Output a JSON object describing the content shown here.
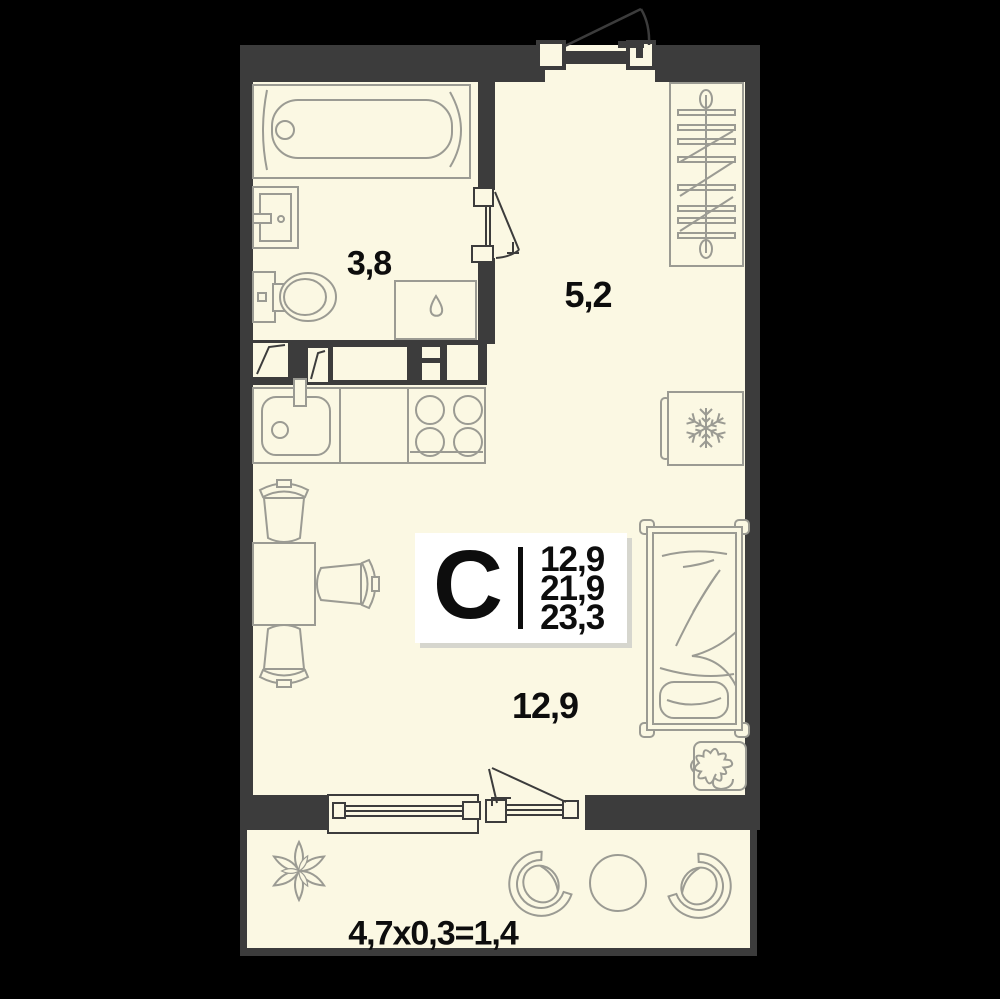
{
  "plan": {
    "stat_card": {
      "type_letter": "С",
      "areas": [
        "12,9",
        "21,9",
        "23,3"
      ]
    },
    "room_labels": {
      "bathroom": "3,8",
      "hallway": "5,2",
      "living_room": "12,9",
      "balcony_formula": "4,7х0,3=1,4"
    },
    "colors": {
      "background": "#000000",
      "walls": "#3c3c3c",
      "floor": "#fbf8e3",
      "furniture_outline": "#9b9b93",
      "card_background": "#ffffff",
      "card_shadow": "#d6d6ce",
      "text": "#0d0d0d"
    },
    "furniture": [
      "bathtub",
      "bathroom-sink",
      "toilet",
      "washing-machine",
      "kitchen-sink",
      "stove",
      "fridge",
      "wardrobe",
      "bed",
      "dining-table",
      "dining-chairs",
      "potted-plant",
      "balcony-armchairs",
      "balcony-round-table",
      "balcony-plant"
    ]
  }
}
